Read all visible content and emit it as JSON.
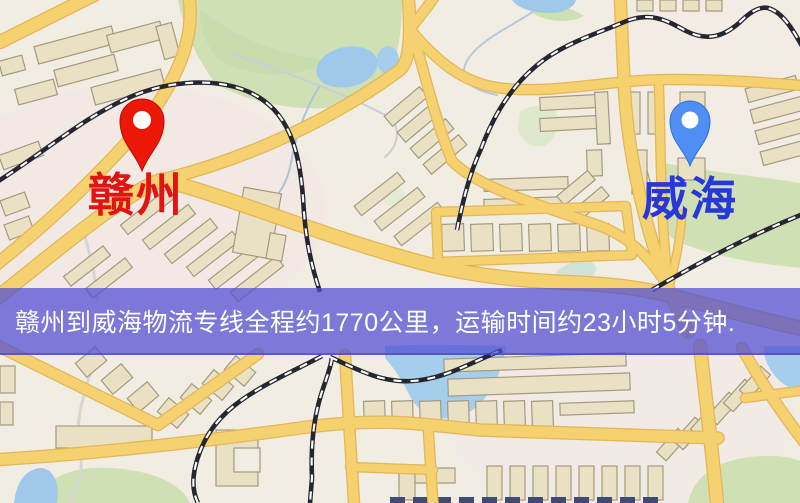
{
  "map": {
    "markers": {
      "origin": {
        "label": "赣州",
        "label_color": "#e21313",
        "pin_color": "#ed1708",
        "icon": "map-pin"
      },
      "destination": {
        "label": "威海",
        "label_color": "#2737d8",
        "pin_color": "#4f8ef3",
        "icon": "map-pin"
      }
    },
    "banner": {
      "text": "赣州到威海物流专线全程约1770公里，运输时间约23小时5分钟.",
      "text_color": "#ffffff",
      "bg_color": "#5250d4"
    },
    "route": {
      "origin_city": "赣州",
      "destination_city": "威海",
      "service": "物流专线",
      "distance_km": "1770",
      "duration": "23小时5分钟"
    },
    "palette": {
      "background": "#f2ede3",
      "road": "#f5d170",
      "road_casing": "#e3b65a",
      "building": "#eae0c4",
      "building_outline": "#a49a80",
      "park": "#cfe0b5",
      "water": "#9fc8ea",
      "railway": "#262630"
    }
  }
}
